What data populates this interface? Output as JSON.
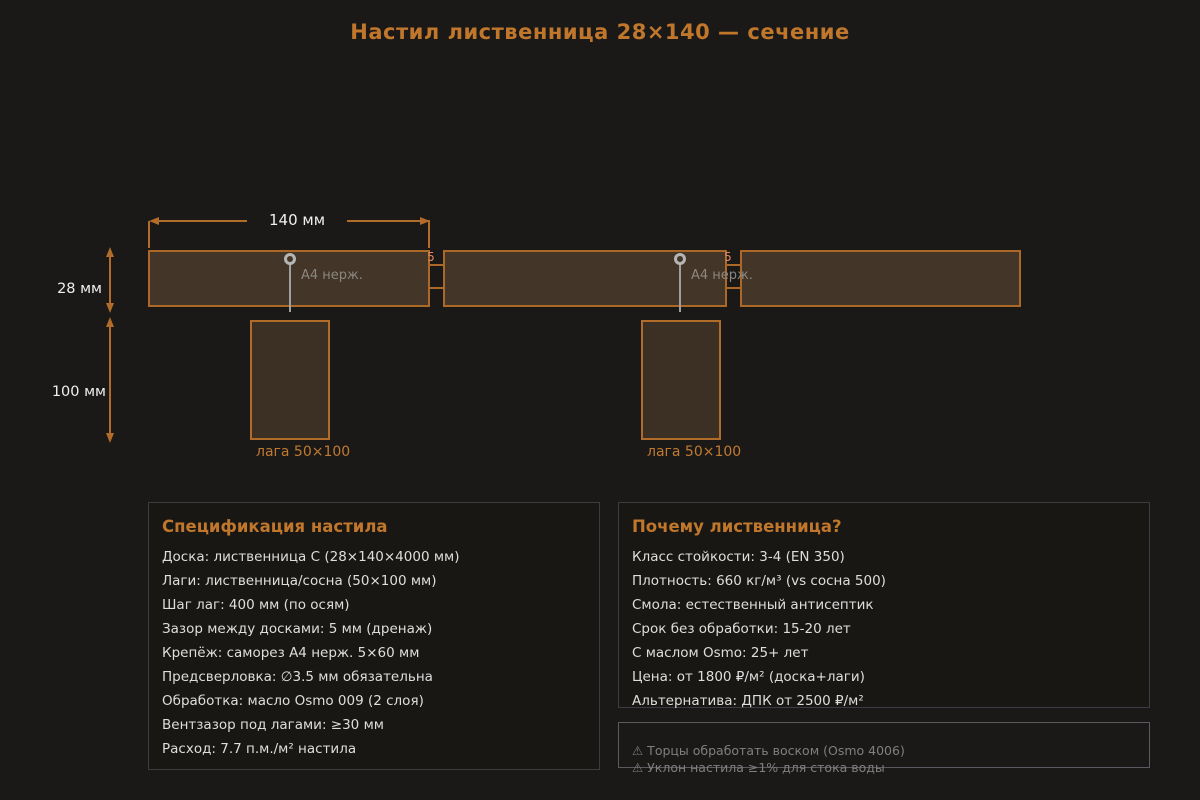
{
  "title": "Настил лиственница 28×140 — сечение",
  "diagram": {
    "dims": {
      "board_width": "140 мм",
      "board_thickness": "28 мм",
      "joist_height": "100 мм"
    },
    "gap_label": "5",
    "screw_label": "A4 нерж.",
    "joist_caption": "лага 50×100"
  },
  "spec_panel": {
    "title": "Спецификация настила",
    "items": [
      "Доска: лиственница С (28×140×4000 мм)",
      "Лаги: лиственница/сосна (50×100 мм)",
      "Шаг лаг: 400 мм (по осям)",
      "Зазор между досками: 5 мм (дренаж)",
      "Крепёж: саморез А4 нерж. 5×60 мм",
      "Предсверловка: ∅3.5 мм обязательна",
      "Обработка: масло Osmo 009 (2 слоя)",
      "Вентзазор под лагами: ≥30 мм",
      "Расход: 7.7 п.м./м² настила"
    ]
  },
  "why_panel": {
    "title": "Почему лиственница?",
    "items": [
      "Класс стойкости: 3-4 (EN 350)",
      "Плотность: 660 кг/м³ (vs сосна 500)",
      "Смола: естественный антисептик",
      "Срок без обработки: 15-20 лет",
      "С маслом Osmo: 25+ лет",
      "Цена: от 1800 ₽/м² (доска+лаги)",
      "Альтернатива: ДПК от 2500 ₽/м²"
    ]
  },
  "warning_panel": {
    "items": [
      "⚠ Торцы обработать воском (Osmo 4006)",
      "⚠ Уклон настила ≥1% для стока воды"
    ]
  },
  "colors": {
    "background": "#1a1918",
    "accent_orange": "#c0772c",
    "board_fill": "#433527",
    "board_border": "#ab6826",
    "gap_label": "#dd8663",
    "screw_gray": "#a0a0a0",
    "panel_border": "#3c3c42",
    "warning_gray": "#7f7f7f"
  }
}
